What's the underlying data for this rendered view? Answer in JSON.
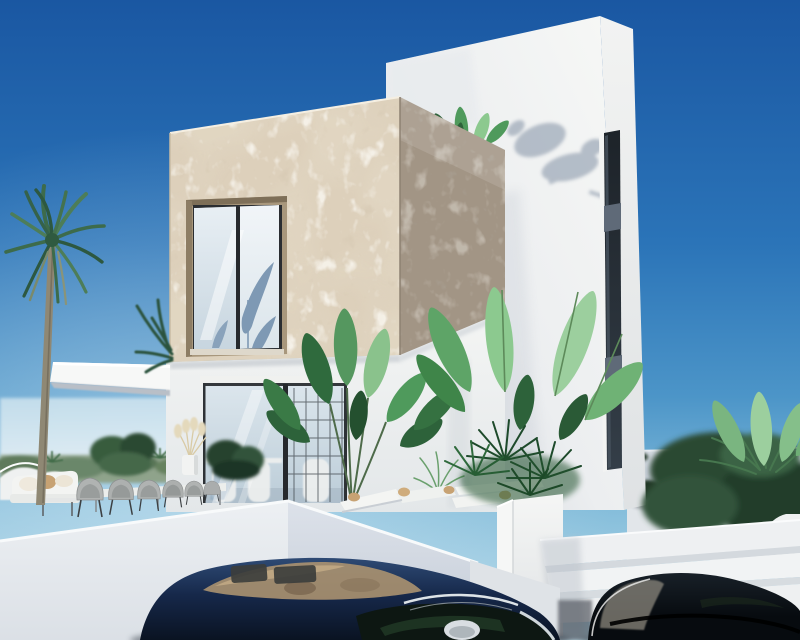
{
  "scene": {
    "description": "Photorealistic 3D architectural render of a modern two-storey villa: cream stone-clad cube over glass sliding doors, white tower with narrow dark window strip, cantilevered white canopy, palm tree, banana plants, rope terrace chairs, white parapet wall, exterior steps and two dark parked cars under a clear blue sky.",
    "objects": [
      "sky",
      "palm-tree",
      "stone-clad-cube",
      "upper-window",
      "white-tower",
      "tower-window-strip",
      "roof-plant",
      "plant-shadow-on-tower",
      "white-canopy",
      "glass-sliding-doors",
      "terrace-furniture",
      "rope-chairs",
      "outdoor-sofa",
      "pampas-pot",
      "center-banana-plant",
      "right-plant-cluster",
      "white-planter",
      "sun-loungers",
      "background-wall",
      "garden-bushes",
      "exterior-steps",
      "parapet-wall",
      "dark-blue-car",
      "black-car"
    ]
  },
  "palette": {
    "skyTop": "#1a57a2",
    "skyMid": "#2b74b8",
    "skyLow": "#4c95c8",
    "skyGlow": "#86bedb",
    "skyHorizon": "#bedfec",
    "stoneLight": "#ddd0bb",
    "stoneSpeckle": "#a8916f",
    "stoneDark": "#a29585",
    "towerWhite": "#f7f8f6",
    "towerShade": "#ccd2d9",
    "frameDark": "#2a2d31",
    "spandrelBlue": "#5f6a78",
    "glassReflect": "#cfdde8",
    "wallWhite": "#f3f4f3",
    "parapetLight": "#edf0f3",
    "parapetShade": "#c3cbd6",
    "groundLight": "#e6e9ec",
    "bgWall": "#c6cdd8",
    "hedgeGreen": "#5e7a5c",
    "leafDark": "#2d623a",
    "leafMid": "#4f9a5c",
    "leafLight": "#8cc98f",
    "palmGreen": "#3d6b4b",
    "trunkBrown": "#8f8874",
    "cushionTan": "#c7a273",
    "chairGray": "#aaaeae",
    "car1Top": "#2e4a74",
    "car1Mid": "#16284a",
    "car1Body": "#0a1322",
    "car1Reflection": "#ab9270",
    "chrome": "#dde3e7",
    "car2Top": "#182028",
    "car2Body": "#070b0f",
    "car2Reflection": "#8a867c"
  }
}
